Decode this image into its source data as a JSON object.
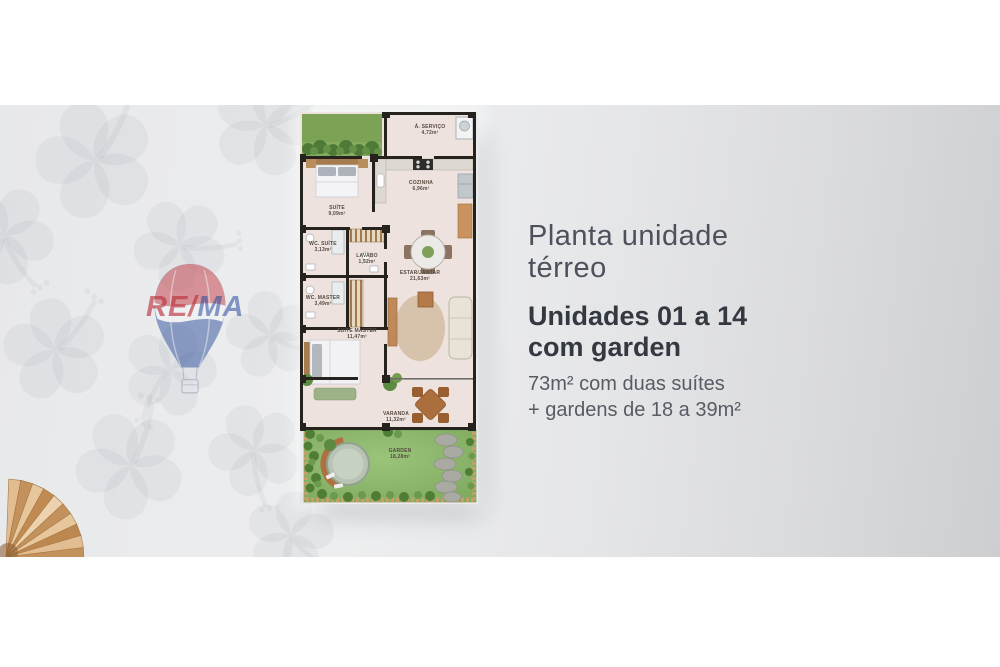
{
  "panel": {
    "title": [
      "Planta unidade",
      "térreo"
    ],
    "subtitle": [
      "Unidades 01 a 14",
      "com garden"
    ],
    "description": [
      "73m² com duas suítes",
      "+ gardens de 18 a 39m²"
    ]
  },
  "watermark": {
    "left": "RE/",
    "right": "MA"
  },
  "floorplan": {
    "rooms": {
      "servico": {
        "name": "Á. SERVIÇO",
        "area": "4,72m²"
      },
      "cozinha": {
        "name": "COZINHA",
        "area": "6,96m²"
      },
      "suite": {
        "name": "SUÍTE",
        "area": "9,09m²"
      },
      "wc_suite": {
        "name": "WC. SUÍTE",
        "area": "3,13m²"
      },
      "lavabo": {
        "name": "LAVABO",
        "area": "1,52m²"
      },
      "estar": {
        "name": "ESTAR/JANTAR",
        "area": "21,63m²"
      },
      "wc_master": {
        "name": "WC. MASTER",
        "area": "3,49m²"
      },
      "suite_master": {
        "name": "SUÍTE MASTER",
        "area": "11,47m²"
      },
      "varanda": {
        "name": "VARANDA",
        "area": "11,32m²"
      },
      "garden": {
        "name": "GARDEN",
        "area": "18,28m²"
      }
    },
    "colors": {
      "wall": "#26221d",
      "floor": "#ede2de",
      "grass": "#83ad60",
      "garden_grass": "#8fbd6f",
      "balloon_red": "#c23a43",
      "balloon_blue": "#2e4f9c",
      "title_text": "#4c515c",
      "subtitle_text": "#343941",
      "description_text": "#575c64"
    }
  }
}
